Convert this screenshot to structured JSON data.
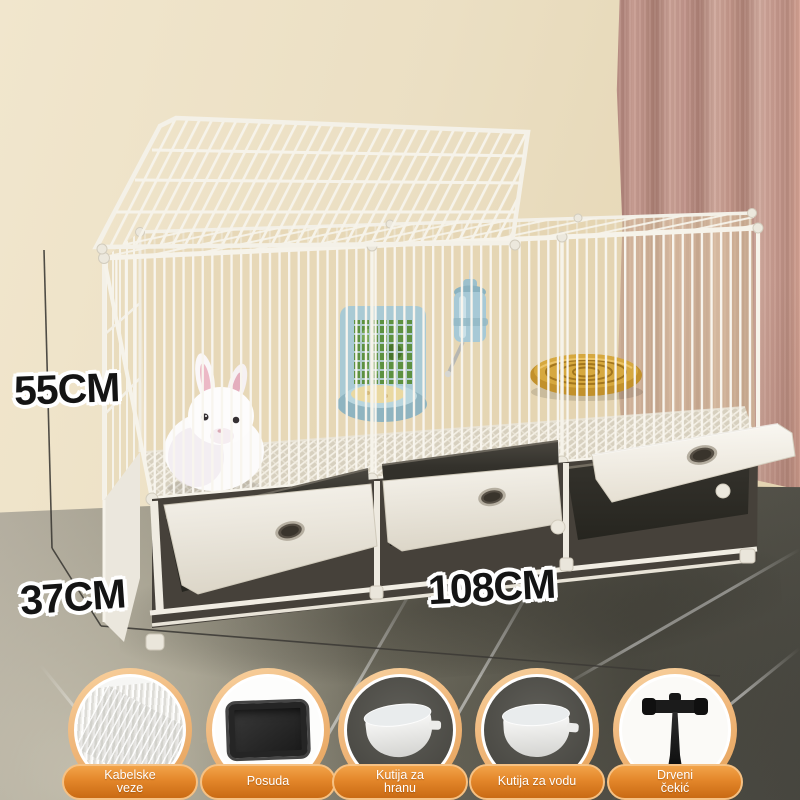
{
  "dimensions": {
    "height": {
      "label": "55CM"
    },
    "depth": {
      "label": "37CM"
    },
    "width": {
      "label": "108CM"
    }
  },
  "accessories": [
    {
      "id": "cable-ties",
      "icon": "cable-ties-icon",
      "label": "Kabelske veze"
    },
    {
      "id": "litter-tray",
      "icon": "tray-icon",
      "label": "Posuda"
    },
    {
      "id": "food-box",
      "icon": "food-bowl-icon",
      "label": "Kutija za hranu"
    },
    {
      "id": "water-box",
      "icon": "water-bowl-icon",
      "label": "Kutija za vodu"
    },
    {
      "id": "wooden-hammer",
      "icon": "hammer-icon",
      "label": "Drveni čekić"
    }
  ],
  "colors": {
    "wall": "#ebdfc3",
    "curtain": "#c79a8e",
    "floor_marble": "#7b7869",
    "cage_white": "#f6f3ea",
    "tray_black": "#2b2924",
    "feeder_blue": "#a9cad4",
    "hay_green": "#5d9140",
    "straw_mat": "#c2912c",
    "accent_orange": "#e3862a",
    "ring_peach": "#f0b87c",
    "dimension_text": "#141414",
    "pill_text": "#ffffff"
  }
}
